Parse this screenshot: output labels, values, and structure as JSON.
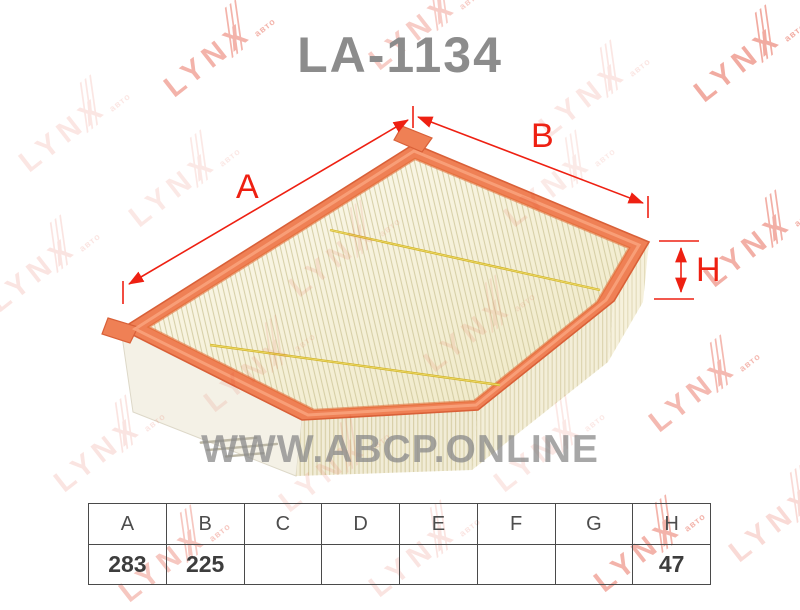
{
  "title": "LA-1134",
  "watermark": {
    "brand": "LYNX",
    "suffix": "авто",
    "site": "WWW.ABCP.ONLINE",
    "color": "#e03a22",
    "positions": [
      {
        "x": 70,
        "y": 130,
        "o": 0.12
      },
      {
        "x": 215,
        "y": 55,
        "o": 0.38
      },
      {
        "x": 420,
        "y": 28,
        "o": 0.25
      },
      {
        "x": 590,
        "y": 95,
        "o": 0.12
      },
      {
        "x": 745,
        "y": 60,
        "o": 0.42
      },
      {
        "x": 40,
        "y": 270,
        "o": 0.13
      },
      {
        "x": 180,
        "y": 185,
        "o": 0.11
      },
      {
        "x": 340,
        "y": 255,
        "o": 0.1
      },
      {
        "x": 555,
        "y": 185,
        "o": 0.1
      },
      {
        "x": 755,
        "y": 245,
        "o": 0.4
      },
      {
        "x": 255,
        "y": 370,
        "o": 0.1
      },
      {
        "x": 475,
        "y": 330,
        "o": 0.1
      },
      {
        "x": 700,
        "y": 390,
        "o": 0.35
      },
      {
        "x": 105,
        "y": 450,
        "o": 0.13
      },
      {
        "x": 330,
        "y": 470,
        "o": 0.11
      },
      {
        "x": 545,
        "y": 450,
        "o": 0.11
      },
      {
        "x": 170,
        "y": 560,
        "o": 0.28
      },
      {
        "x": 420,
        "y": 555,
        "o": 0.13
      },
      {
        "x": 645,
        "y": 550,
        "o": 0.38
      },
      {
        "x": 780,
        "y": 520,
        "o": 0.18
      }
    ]
  },
  "diagram": {
    "labels": {
      "a": "A",
      "b": "B",
      "h": "H"
    },
    "line_color": "#ee2012"
  },
  "table": {
    "headers": [
      "A",
      "B",
      "C",
      "D",
      "E",
      "F",
      "G",
      "H"
    ],
    "values": [
      "283",
      "225",
      "",
      "",
      "",
      "",
      "",
      "47"
    ]
  }
}
